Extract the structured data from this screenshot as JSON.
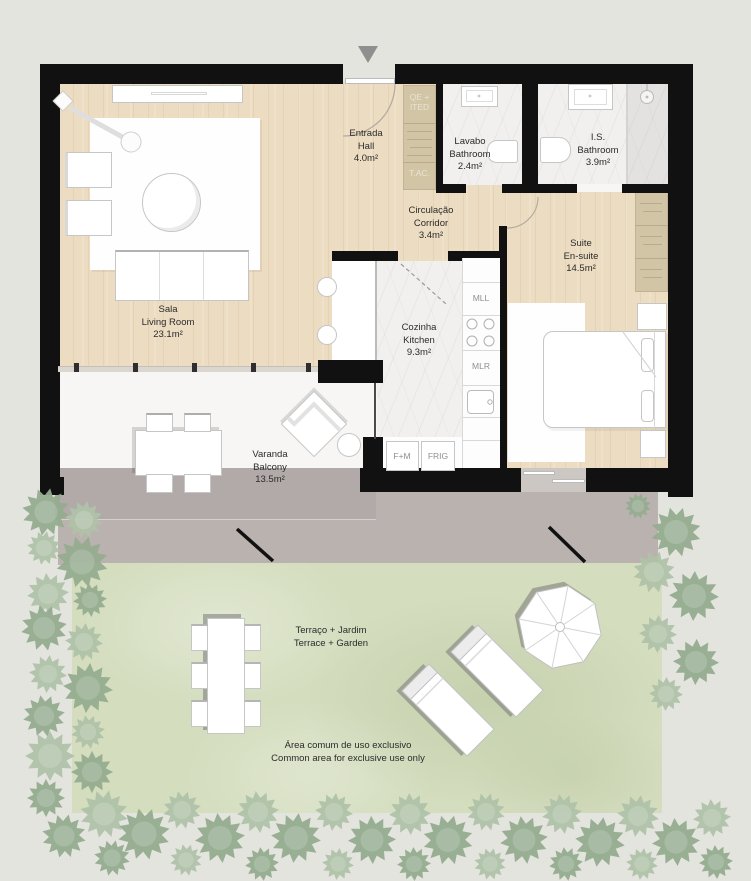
{
  "rooms": {
    "hall": {
      "name_pt": "Entrada",
      "name_en": "Hall",
      "area": "4.0m²"
    },
    "lavabo": {
      "name_pt": "Lavabo",
      "name_en": "Bathroom",
      "area": "2.4m²"
    },
    "is_bathroom": {
      "name_pt": "I.S.",
      "name_en": "Bathroom",
      "area": "3.9m²"
    },
    "corridor": {
      "name_pt": "Circulação",
      "name_en": "Corridor",
      "area": "3.4m²"
    },
    "suite": {
      "name_pt": "Suite",
      "name_en": "En-suite",
      "area": "14.5m²"
    },
    "living": {
      "name_pt": "Sala",
      "name_en": "Living Room",
      "area": "23.1m²"
    },
    "kitchen": {
      "name_pt": "Cozinha",
      "name_en": "Kitchen",
      "area": "9.3m²"
    },
    "balcony": {
      "name_pt": "Varanda",
      "name_en": "Balcony",
      "area": "13.5m²"
    },
    "terrace_garden": {
      "name_pt": "Terraço + Jardim",
      "name_en": "Terrace + Garden"
    }
  },
  "annotations": {
    "common_area_pt": "Área comum de uso exclusivo",
    "common_area_en": "Common area for exclusive use only"
  },
  "technical": {
    "qe_ited": "QE + ITED",
    "tac": "T.AC.",
    "mll": "MLL",
    "mlr": "MLR",
    "fm": "F+M",
    "frig": "FRIG"
  },
  "icons": {
    "entrance_marker": "triangle-down-icon"
  },
  "colors": {
    "wall": "#111111",
    "wood_floor": "#ecdcc2",
    "marble_floor": "#f1f0ee",
    "cabinet_tan": "#d2c5a6",
    "balcony_gray": "#b2aaa8",
    "terrace_gray": "#b9b2af",
    "grass_green": "#d4ddbe",
    "tree_green_dark": "#95ac8f",
    "tree_green_light": "#afc2a8",
    "background": "#e4e4df",
    "label_text": "#2b2b2b"
  }
}
